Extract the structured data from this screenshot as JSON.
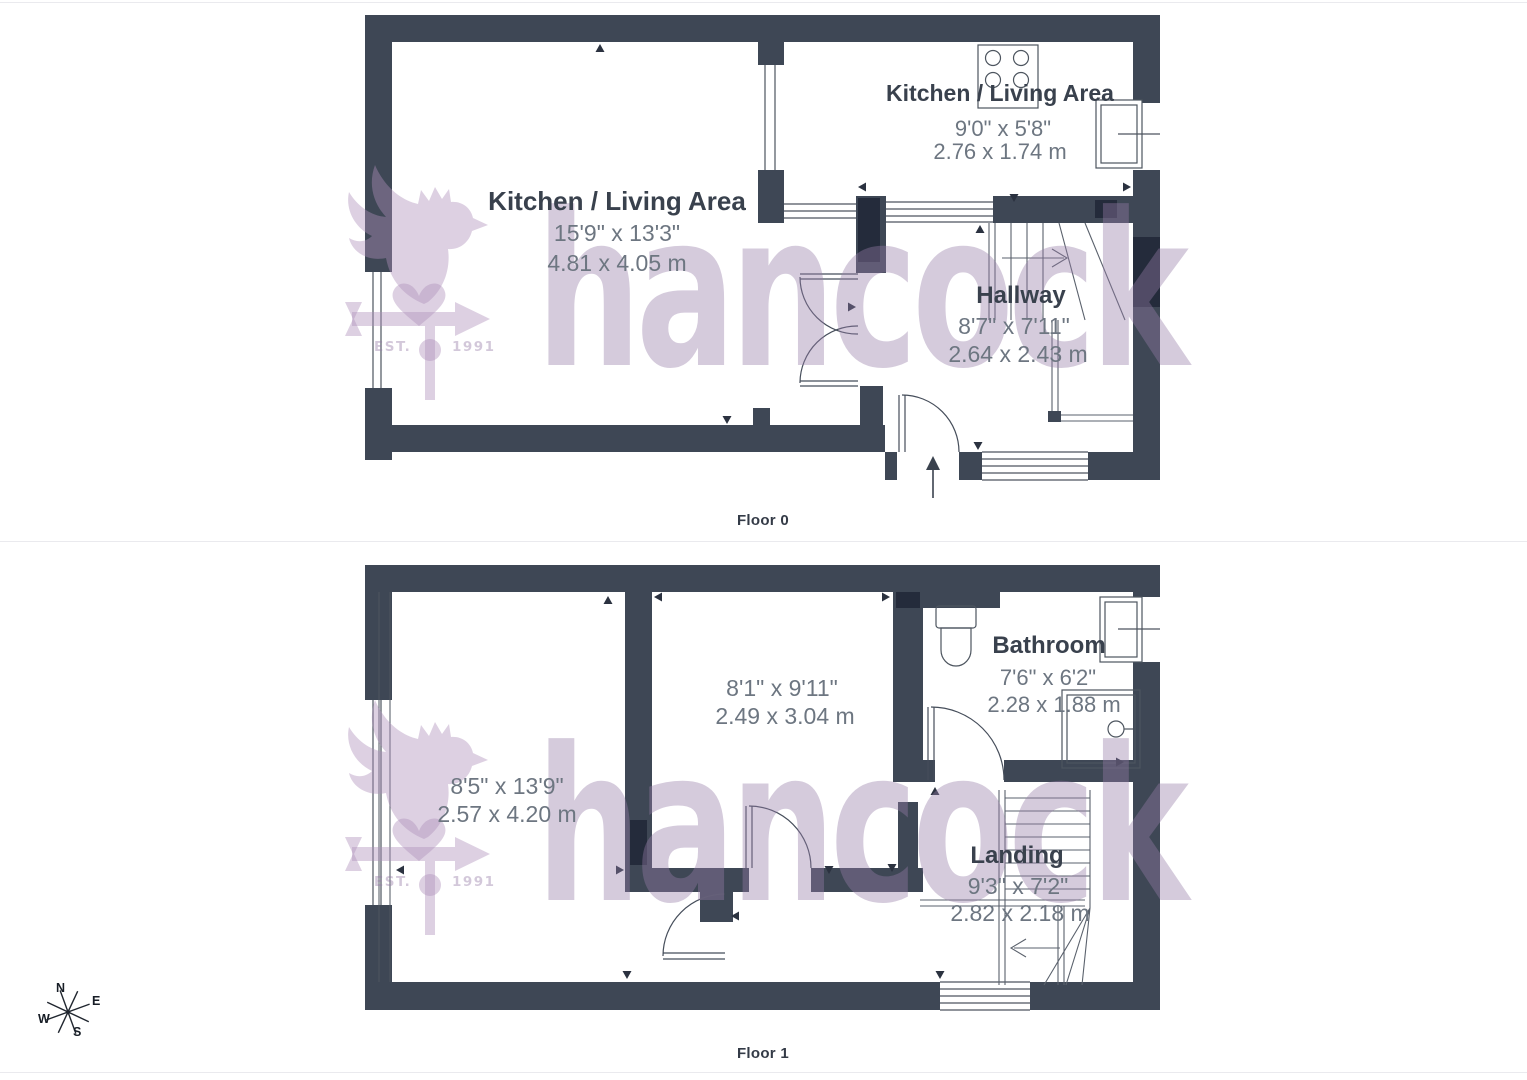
{
  "floor0": {
    "label": "Floor 0",
    "rooms": [
      {
        "name": "Kitchen / Living Area",
        "dims_imperial": "15'9\" x 13'3\"",
        "dims_metric": "4.81 x 4.05 m"
      },
      {
        "name": "Kitchen / Living Area",
        "dims_imperial": "9'0\" x 5'8\"",
        "dims_metric": "2.76 x 1.74 m"
      },
      {
        "name": "Hallway",
        "dims_imperial": "8'7\" x 7'11\"",
        "dims_metric": "2.64 x 2.43 m"
      }
    ]
  },
  "floor1": {
    "label": "Floor 1",
    "rooms": [
      {
        "name": "",
        "dims_imperial": "8'5\" x 13'9\"",
        "dims_metric": "2.57 x 4.20 m"
      },
      {
        "name": "",
        "dims_imperial": "8'1\" x 9'11\"",
        "dims_metric": "2.49 x 3.04 m"
      },
      {
        "name": "Bathroom",
        "dims_imperial": "7'6\" x 6'2\"",
        "dims_metric": "2.28 x 1.88 m"
      },
      {
        "name": "Landing",
        "dims_imperial": "9'3\" x 7'2\"",
        "dims_metric": "2.82 x 2.18 m"
      }
    ]
  },
  "watermark": {
    "brand": "hancock",
    "est_label": "EST.",
    "year": "1991"
  },
  "compass": {
    "north": "N",
    "east": "E",
    "south": "S",
    "west": "W"
  },
  "colors": {
    "wall": "#3e4755",
    "wall_accent": "#242b3b",
    "line": "#4d555f",
    "room_name_text": "#39414d",
    "dims_text": "#6d7681",
    "watermark_tint": "#d5cbdc"
  }
}
